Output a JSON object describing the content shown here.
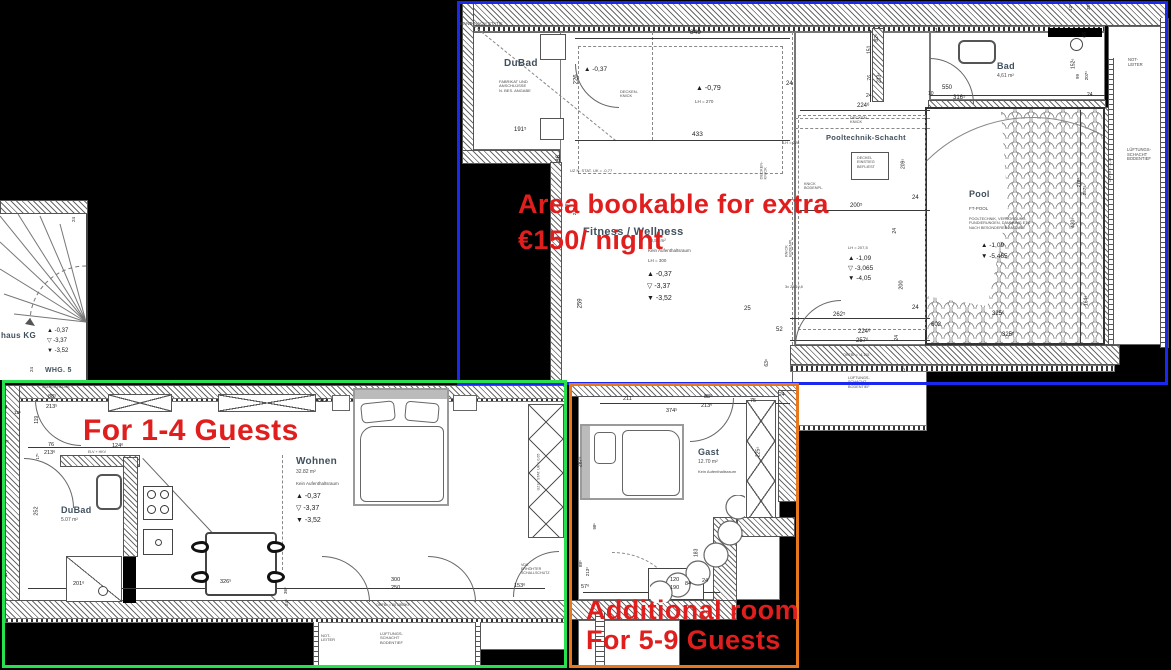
{
  "annotations": {
    "note_color": "#e01e1e",
    "boxes": [
      {
        "name": "bookable-area-box",
        "color": "#1a28f0",
        "x": 457,
        "y": 1,
        "w": 711,
        "h": 384
      },
      {
        "name": "guests-1-4-box",
        "color": "#27e24e",
        "x": 2,
        "y": 380,
        "w": 565,
        "h": 288
      },
      {
        "name": "additional-room-box",
        "color": "#e8781d",
        "x": 569,
        "y": 383,
        "w": 230,
        "h": 285
      }
    ],
    "notes": [
      {
        "name": "bookable-note",
        "text": "Area bookable for extra\n€150/ night",
        "x": 518,
        "y": 186,
        "size": 27,
        "lh": 36
      },
      {
        "name": "guests-note",
        "text": "For 1-4 Guests",
        "x": 83,
        "y": 414,
        "size": 30,
        "lh": 34
      },
      {
        "name": "additional-note",
        "text": "Additional room\nFor 5-9 Guests",
        "x": 586,
        "y": 595,
        "size": 27,
        "lh": 30
      }
    ]
  },
  "labels": [
    {
      "t": "WAND NACH STATIK",
      "x": 459,
      "y": 21,
      "s": 4.5,
      "c": "sub"
    },
    {
      "t": "DuBad",
      "x": 504,
      "y": 58,
      "s": 10,
      "c": "room"
    },
    {
      "t": "FABRIKAT UND\nANSCHLÜSSE\nN. BES. ANGABE",
      "x": 499,
      "y": 80,
      "s": 4,
      "c": "sub"
    },
    {
      "t": "191⁵",
      "x": 514,
      "y": 127,
      "s": 6
    },
    {
      "t": "226",
      "x": 572,
      "y": 76,
      "s": 6,
      "r": 90
    },
    {
      "t": "▲ -0,37",
      "x": 584,
      "y": 66,
      "s": 6.5
    },
    {
      "t": "849",
      "x": 690,
      "y": 29,
      "s": 6.5
    },
    {
      "t": "▲ -0,79",
      "x": 696,
      "y": 85,
      "s": 7
    },
    {
      "t": "LH = 270",
      "x": 695,
      "y": 99,
      "s": 4.5,
      "c": "sub"
    },
    {
      "t": "DECKEN-\nKNICK",
      "x": 620,
      "y": 90,
      "s": 4,
      "c": "sub"
    },
    {
      "t": "433",
      "x": 692,
      "y": 131,
      "s": 6.5
    },
    {
      "t": "24",
      "x": 786,
      "y": 81,
      "s": 6
    },
    {
      "t": "LH = 228",
      "x": 783,
      "y": 141,
      "s": 4,
      "c": "sub"
    },
    {
      "t": "DECKEN-\nKNICK",
      "x": 850,
      "y": 116,
      "s": 4,
      "c": "sub"
    },
    {
      "t": "DECKEN-\nKNICK",
      "x": 755,
      "y": 166,
      "s": 4,
      "r": 90,
      "c": "sub"
    },
    {
      "t": "UZ N. STAT. UK = -0,77",
      "x": 570,
      "y": 169,
      "s": 4,
      "c": "sub"
    },
    {
      "t": "86",
      "x": 556,
      "y": 155,
      "s": 6,
      "r": 90
    },
    {
      "t": "88⁶",
      "x": 563,
      "y": 203,
      "s": 4.5,
      "r": 90
    },
    {
      "t": "213⁶",
      "x": 570,
      "y": 208,
      "s": 4.5,
      "r": 90
    },
    {
      "t": "Fitness / Wellness",
      "x": 583,
      "y": 226,
      "s": 11,
      "c": "room"
    },
    {
      "t": "40,50 m²",
      "x": 648,
      "y": 238,
      "s": 4.5,
      "c": "sub"
    },
    {
      "t": "Kein Aufenthaltsraum",
      "x": 648,
      "y": 248,
      "s": 4.5,
      "c": "sub"
    },
    {
      "t": "LH = 300",
      "x": 648,
      "y": 258,
      "s": 4.5,
      "c": "sub"
    },
    {
      "t": "▲ -0,37",
      "x": 647,
      "y": 271,
      "s": 7
    },
    {
      "t": "▽ -3,37",
      "x": 647,
      "y": 283,
      "s": 7
    },
    {
      "t": "▼ -3,52",
      "x": 647,
      "y": 295,
      "s": 7
    },
    {
      "t": "259",
      "x": 576,
      "y": 300,
      "s": 6,
      "r": 90
    },
    {
      "t": "25",
      "x": 744,
      "y": 306,
      "s": 6
    },
    {
      "t": "262⁵",
      "x": 833,
      "y": 312,
      "s": 6
    },
    {
      "t": "52",
      "x": 776,
      "y": 327,
      "s": 6
    },
    {
      "t": "63⁶",
      "x": 764,
      "y": 360,
      "s": 5,
      "r": 90
    },
    {
      "t": "KNICK\nBODENPL.",
      "x": 779,
      "y": 243,
      "s": 3.8,
      "r": 90,
      "c": "sub"
    },
    {
      "t": "3x 25/19,8",
      "x": 785,
      "y": 285,
      "s": 3.8,
      "c": "sub"
    },
    {
      "t": "KNICK\nBODENPL.",
      "x": 804,
      "y": 182,
      "s": 3.8,
      "c": "sub"
    },
    {
      "t": "Pooltechnik-Schacht",
      "x": 826,
      "y": 134,
      "s": 7.5,
      "c": "room"
    },
    {
      "t": "224⁶",
      "x": 857,
      "y": 103,
      "s": 6
    },
    {
      "t": "DECKEL\nEINSTIEG\nBEFLIEST",
      "x": 857,
      "y": 156,
      "s": 3.8,
      "c": "sub"
    },
    {
      "t": "209⁵",
      "x": 899,
      "y": 161,
      "s": 5,
      "r": 90
    },
    {
      "t": "24",
      "x": 912,
      "y": 195,
      "s": 6
    },
    {
      "t": "200⁵",
      "x": 850,
      "y": 203,
      "s": 6
    },
    {
      "t": "24",
      "x": 893,
      "y": 228,
      "s": 5,
      "r": 90
    },
    {
      "t": "LH = 207,5",
      "x": 848,
      "y": 246,
      "s": 4,
      "c": "sub"
    },
    {
      "t": "▲ -1,09",
      "x": 848,
      "y": 255,
      "s": 6.5
    },
    {
      "t": "▽ -3,065",
      "x": 848,
      "y": 265,
      "s": 6.5
    },
    {
      "t": "▼ -4,05",
      "x": 848,
      "y": 275,
      "s": 6.5
    },
    {
      "t": "200",
      "x": 897,
      "y": 282,
      "s": 5.5,
      "r": 90
    },
    {
      "t": "24",
      "x": 912,
      "y": 305,
      "s": 6
    },
    {
      "t": "224⁶",
      "x": 858,
      "y": 329,
      "s": 6
    },
    {
      "t": "257⁶",
      "x": 856,
      "y": 338,
      "s": 6
    },
    {
      "t": "24",
      "x": 895,
      "y": 335,
      "s": 5,
      "r": 90
    },
    {
      "t": "OKFBr = -4,115",
      "x": 843,
      "y": 353,
      "s": 3.8,
      "c": "sub"
    },
    {
      "t": "LÜFTUNGS-\nSCHACHT\nBODENTIEF",
      "x": 848,
      "y": 376,
      "s": 3.8,
      "c": "sub"
    },
    {
      "t": "12⁵",
      "x": 901,
      "y": 367,
      "s": 4,
      "r": 90
    },
    {
      "t": "602",
      "x": 931,
      "y": 322,
      "s": 6
    },
    {
      "t": "325⁶",
      "x": 992,
      "y": 311,
      "s": 6
    },
    {
      "t": "325⁵",
      "x": 1002,
      "y": 332,
      "s": 6
    },
    {
      "t": "Pool",
      "x": 969,
      "y": 189,
      "s": 9,
      "c": "room"
    },
    {
      "t": "FT-POOL",
      "x": 969,
      "y": 206,
      "s": 4.5,
      "c": "sub"
    },
    {
      "t": "POOLTECHNIK, VERSORGUNG,\nFUNDIERUNGEN, DÄMMUNG ETC\nNACH BESONDERER ANGABE",
      "x": 969,
      "y": 217,
      "s": 3.8,
      "c": "sub"
    },
    {
      "t": "▲ -1,09",
      "x": 981,
      "y": 242,
      "s": 6.5
    },
    {
      "t": "▼ -5,465",
      "x": 981,
      "y": 253,
      "s": 6.5
    },
    {
      "t": "430⁵",
      "x": 1069,
      "y": 220,
      "s": 5,
      "r": 90
    },
    {
      "t": "164⁶",
      "x": 1082,
      "y": 298,
      "s": 5,
      "r": 90
    },
    {
      "t": "278⁶",
      "x": 1074,
      "y": 180,
      "s": 4.5,
      "r": 90
    },
    {
      "t": "257⁶",
      "x": 1080,
      "y": 188,
      "s": 4.5,
      "r": 90
    },
    {
      "t": "OKFBr = -4,16",
      "x": 1098,
      "y": 168,
      "s": 3.8,
      "r": 90,
      "c": "sub"
    },
    {
      "t": "Bad",
      "x": 997,
      "y": 61,
      "s": 9,
      "c": "room"
    },
    {
      "t": "4,61 m²",
      "x": 997,
      "y": 74,
      "s": 5,
      "c": "sub"
    },
    {
      "t": "550",
      "x": 942,
      "y": 85,
      "s": 6
    },
    {
      "t": "316⁵",
      "x": 953,
      "y": 95,
      "s": 6
    },
    {
      "t": "10",
      "x": 928,
      "y": 92,
      "s": 5
    },
    {
      "t": "10",
      "x": 935,
      "y": 29,
      "s": 5
    },
    {
      "t": "82⁶",
      "x": 874,
      "y": 35,
      "s": 5,
      "r": 90
    },
    {
      "t": "151",
      "x": 866,
      "y": 47,
      "s": 5,
      "r": 90
    },
    {
      "t": "76",
      "x": 868,
      "y": 75,
      "s": 5,
      "r": 90
    },
    {
      "t": "213⁶",
      "x": 875,
      "y": 75,
      "s": 5,
      "r": 90
    },
    {
      "t": "24",
      "x": 866,
      "y": 94,
      "s": 5
    },
    {
      "t": "152⁶",
      "x": 1069,
      "y": 61,
      "s": 5,
      "r": 90
    },
    {
      "t": "66",
      "x": 1083,
      "y": 32,
      "s": 5,
      "r": 90
    },
    {
      "t": "99",
      "x": 1075,
      "y": 74,
      "s": 4.5,
      "r": 90
    },
    {
      "t": "207⁶",
      "x": 1082,
      "y": 73,
      "s": 4.5,
      "r": 90
    },
    {
      "t": "24",
      "x": 1087,
      "y": 93,
      "s": 5
    },
    {
      "t": "12⁶",
      "x": 1067,
      "y": 5,
      "s": 4.5,
      "r": 90
    },
    {
      "t": "35⁶",
      "x": 1085,
      "y": 4,
      "s": 4.5,
      "r": 90
    },
    {
      "t": "NOT-\nLEITER",
      "x": 1128,
      "y": 58,
      "s": 4.2,
      "c": "sub"
    },
    {
      "t": "LÜFTUNGS-\nSCHACHT\nBODENTIEF",
      "x": 1127,
      "y": 148,
      "s": 4.2,
      "c": "sub"
    },
    {
      "t": "haus KG",
      "x": 1,
      "y": 332,
      "s": 8,
      "c": "room"
    },
    {
      "t": "▲ -0,37",
      "x": 47,
      "y": 328,
      "s": 6
    },
    {
      "t": "▽ -3,37",
      "x": 47,
      "y": 338,
      "s": 6
    },
    {
      "t": "▼ -3,52",
      "x": 47,
      "y": 348,
      "s": 6
    },
    {
      "t": "WHG. 5",
      "x": 45,
      "y": 367,
      "s": 7,
      "c": "room"
    },
    {
      "t": "24",
      "x": 29,
      "y": 367,
      "s": 4.5,
      "r": 90
    },
    {
      "t": "24",
      "x": 71,
      "y": 217,
      "s": 4.5,
      "r": 90
    },
    {
      "t": "KDS\nCODESCHLOSS",
      "x": 42,
      "y": 381,
      "s": 3.6,
      "c": "sub"
    },
    {
      "t": "88⁵",
      "x": 48,
      "y": 394,
      "s": 5.5
    },
    {
      "t": "213⁵",
      "x": 46,
      "y": 404,
      "s": 5.5
    },
    {
      "t": "24",
      "x": 2,
      "y": 406,
      "s": 5
    },
    {
      "t": "12⁶",
      "x": 14,
      "y": 410,
      "s": 4.5
    },
    {
      "t": "119",
      "x": 34,
      "y": 417,
      "s": 5,
      "r": 90
    },
    {
      "t": "12⁵",
      "x": 2,
      "y": 439,
      "s": 4.5
    },
    {
      "t": "76",
      "x": 48,
      "y": 442,
      "s": 5.5
    },
    {
      "t": "213⁶",
      "x": 44,
      "y": 450,
      "s": 5.5
    },
    {
      "t": "124⁶",
      "x": 112,
      "y": 443,
      "s": 5.5
    },
    {
      "t": "ELV + HKV",
      "x": 88,
      "y": 450,
      "s": 3.6,
      "c": "sub"
    },
    {
      "t": "17⁵",
      "x": 35,
      "y": 454,
      "s": 4.2,
      "r": 90
    },
    {
      "t": "252",
      "x": 32,
      "y": 508,
      "s": 5.5,
      "r": 90
    },
    {
      "t": "DuBad",
      "x": 61,
      "y": 505,
      "s": 9,
      "c": "room"
    },
    {
      "t": "5.07 m²",
      "x": 61,
      "y": 518,
      "s": 5,
      "c": "sub"
    },
    {
      "t": "201⁶",
      "x": 73,
      "y": 581,
      "s": 5.5
    },
    {
      "t": "24",
      "x": 2,
      "y": 574,
      "s": 5
    },
    {
      "t": "326⁵",
      "x": 220,
      "y": 579,
      "s": 5.5
    },
    {
      "t": "36⁶",
      "x": 282,
      "y": 588,
      "s": 4.5,
      "r": 90
    },
    {
      "t": "24⁵",
      "x": 283,
      "y": 600,
      "s": 4.5,
      "r": 90
    },
    {
      "t": "892",
      "x": 318,
      "y": 398,
      "s": 5.5
    },
    {
      "t": "24",
      "x": 169,
      "y": 380,
      "s": 4.2,
      "r": 90
    },
    {
      "t": "Wohnen",
      "x": 296,
      "y": 456,
      "s": 10,
      "c": "room"
    },
    {
      "t": "32.82 m²",
      "x": 296,
      "y": 470,
      "s": 5,
      "c": "sub"
    },
    {
      "t": "Kein Aufenthaltsraum",
      "x": 296,
      "y": 481,
      "s": 4.5,
      "c": "sub"
    },
    {
      "t": "▲ -0,37",
      "x": 296,
      "y": 493,
      "s": 7
    },
    {
      "t": "▽ -3,37",
      "x": 296,
      "y": 505,
      "s": 7
    },
    {
      "t": "▼ -3,52",
      "x": 296,
      "y": 517,
      "s": 7
    },
    {
      "t": "UZ N. STAT. UK = 0,65",
      "x": 520,
      "y": 470,
      "s": 3.6,
      "r": 90,
      "c": "sub"
    },
    {
      "t": "VDS\nERHÖHTER\nSCHALLSCHUTZ",
      "x": 521,
      "y": 563,
      "s": 3.6,
      "c": "sub"
    },
    {
      "t": "153⁶",
      "x": 514,
      "y": 583,
      "s": 5.5
    },
    {
      "t": "300",
      "x": 391,
      "y": 577,
      "s": 5.5
    },
    {
      "t": "250",
      "x": 391,
      "y": 585,
      "s": 5.5
    },
    {
      "t": "OKFBr = 20 ÜBOKF",
      "x": 376,
      "y": 603,
      "s": 3.8,
      "c": "sub"
    },
    {
      "t": "NOT-\nLEITER",
      "x": 321,
      "y": 634,
      "s": 4,
      "c": "sub"
    },
    {
      "t": "LÜFTUNGS-\nSCHACHT\nBODENTIEF",
      "x": 380,
      "y": 632,
      "s": 4,
      "c": "sub"
    },
    {
      "t": "211",
      "x": 623,
      "y": 396,
      "s": 5.5
    },
    {
      "t": "88⁶",
      "x": 704,
      "y": 394,
      "s": 5.5
    },
    {
      "t": "213⁶",
      "x": 701,
      "y": 403,
      "s": 5.5
    },
    {
      "t": "374⁵",
      "x": 666,
      "y": 408,
      "s": 5.5
    },
    {
      "t": "75",
      "x": 750,
      "y": 398,
      "s": 5.5
    },
    {
      "t": "24",
      "x": 779,
      "y": 393,
      "s": 5
    },
    {
      "t": "Gast",
      "x": 698,
      "y": 447,
      "s": 9,
      "c": "room"
    },
    {
      "t": "12.70 m²",
      "x": 698,
      "y": 460,
      "s": 5,
      "c": "sub"
    },
    {
      "t": "Kein Aufenthaltsraum",
      "x": 698,
      "y": 470,
      "s": 4,
      "c": "sub"
    },
    {
      "t": "225⁵",
      "x": 754,
      "y": 449,
      "s": 5,
      "r": 90
    },
    {
      "t": "287⁶",
      "x": 576,
      "y": 459,
      "s": 5,
      "r": 90
    },
    {
      "t": "98⁶",
      "x": 592,
      "y": 524,
      "s": 4.2,
      "r": 90
    },
    {
      "t": "88⁶",
      "x": 577,
      "y": 561,
      "s": 4.5,
      "r": 90
    },
    {
      "t": "213⁶",
      "x": 583,
      "y": 569,
      "s": 4.5,
      "r": 90
    },
    {
      "t": "57⁶",
      "x": 581,
      "y": 584,
      "s": 5.5
    },
    {
      "t": "120",
      "x": 670,
      "y": 577,
      "s": 5.5
    },
    {
      "t": "190",
      "x": 670,
      "y": 585,
      "s": 5.5
    },
    {
      "t": "84",
      "x": 685,
      "y": 581,
      "s": 5.5
    },
    {
      "t": "24",
      "x": 702,
      "y": 578,
      "s": 5.5
    },
    {
      "t": "183",
      "x": 693,
      "y": 550,
      "s": 5,
      "r": 90
    }
  ]
}
